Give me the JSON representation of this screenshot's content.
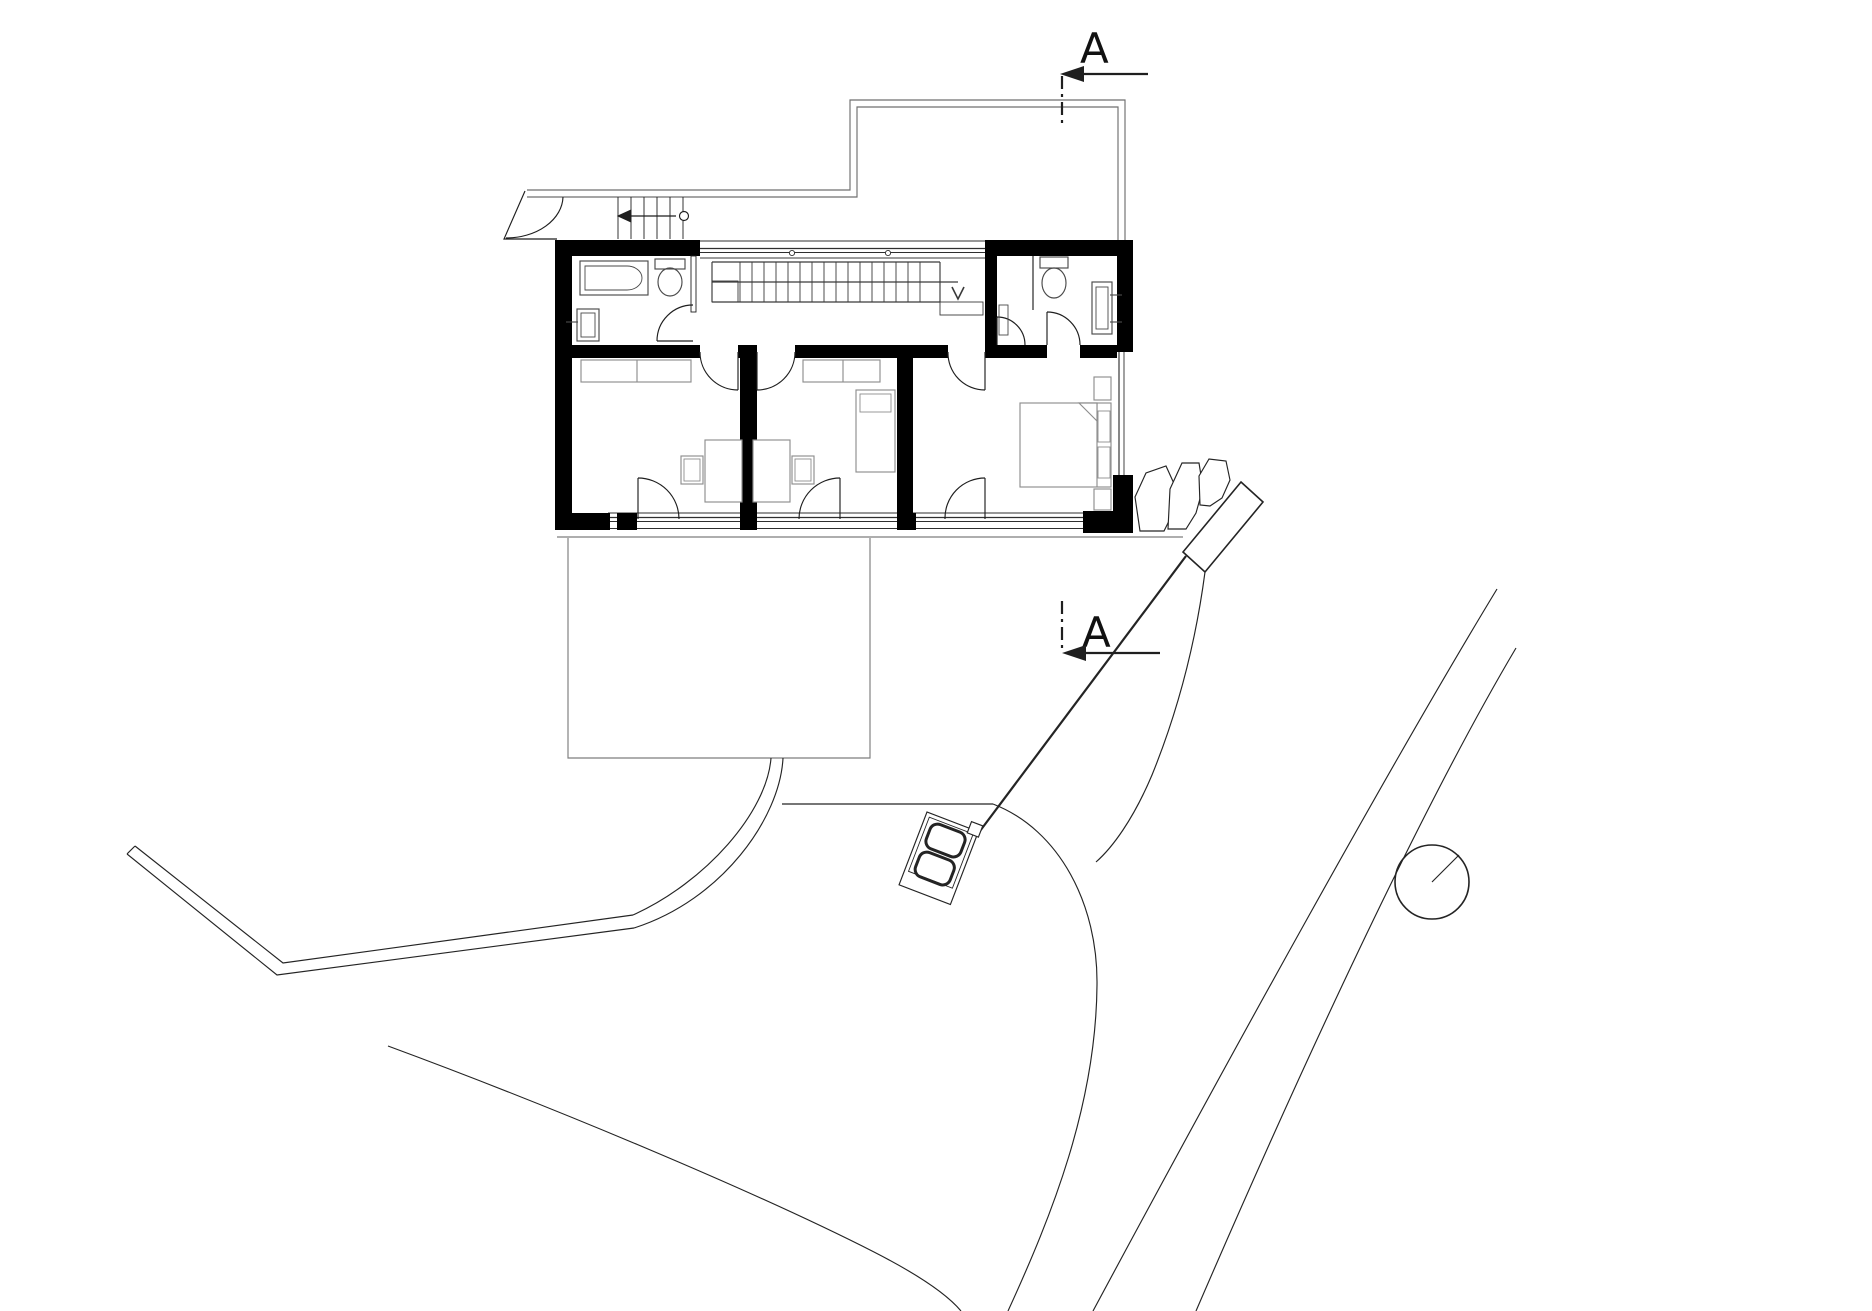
{
  "drawing": {
    "kind": "architectural floor plan with site plan",
    "background": "#ffffff"
  },
  "section_markers": {
    "top": {
      "label": "A"
    },
    "bottom": {
      "label": "A"
    }
  },
  "colors": {
    "wall": "#000000",
    "line": "#1f1f1f",
    "roof": "#6f6f6f",
    "terrace": "#7d7d7d",
    "furniture": "#8d8d8d",
    "fixture": "#4a4a4a",
    "stair": "#3a3a3a",
    "glazing": "#2f2f2f",
    "site": "#242424",
    "text": "#111111"
  },
  "symbols": {
    "tree": "tree-circle-with-radius-line",
    "car": "parked-car-top-view",
    "rocks": "boulder-outlines",
    "stair_arrows": "direction-arrows"
  }
}
